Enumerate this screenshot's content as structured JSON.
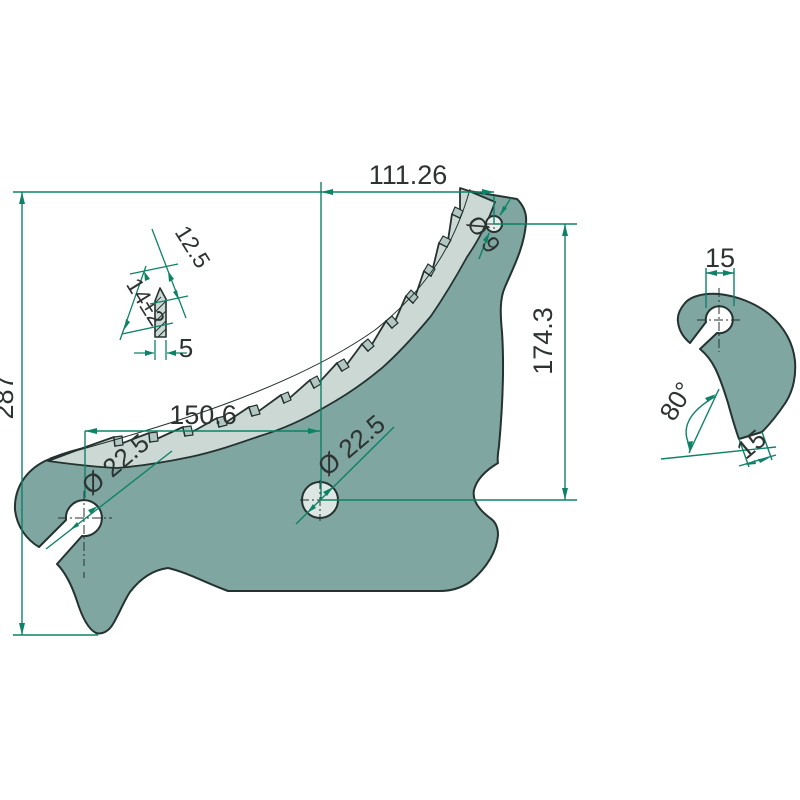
{
  "drawing": {
    "kind": "technical-part-drawing",
    "part": "serrated cutter blade with keyhole slot, tooth detail and side profile view"
  },
  "dimensions": {
    "overall_height": "287",
    "tip_offset_width": "111.26",
    "tip_hole_height": "174.3",
    "hole_spacing": "150.6",
    "left_hole_diameter": "Ø 22.5",
    "center_hole_diameter": "Ø 22.5",
    "tip_hole_diameter": "Ø 9",
    "tooth_bevel": "12.5",
    "tooth_length": "14±2",
    "tooth_width": "5",
    "side_hole_width": "15",
    "side_angle": "80°",
    "side_tip_width": "15"
  },
  "colors": {
    "body": "#7FA6A1",
    "edge_band": "#CBD8D3",
    "edge_facet": "#B3C7C2",
    "hole_fill": "#DDE6E2",
    "dimension_green": "#0E8266",
    "outline": "#243230",
    "text": "#2D3331",
    "background": "#FFFFFF"
  }
}
